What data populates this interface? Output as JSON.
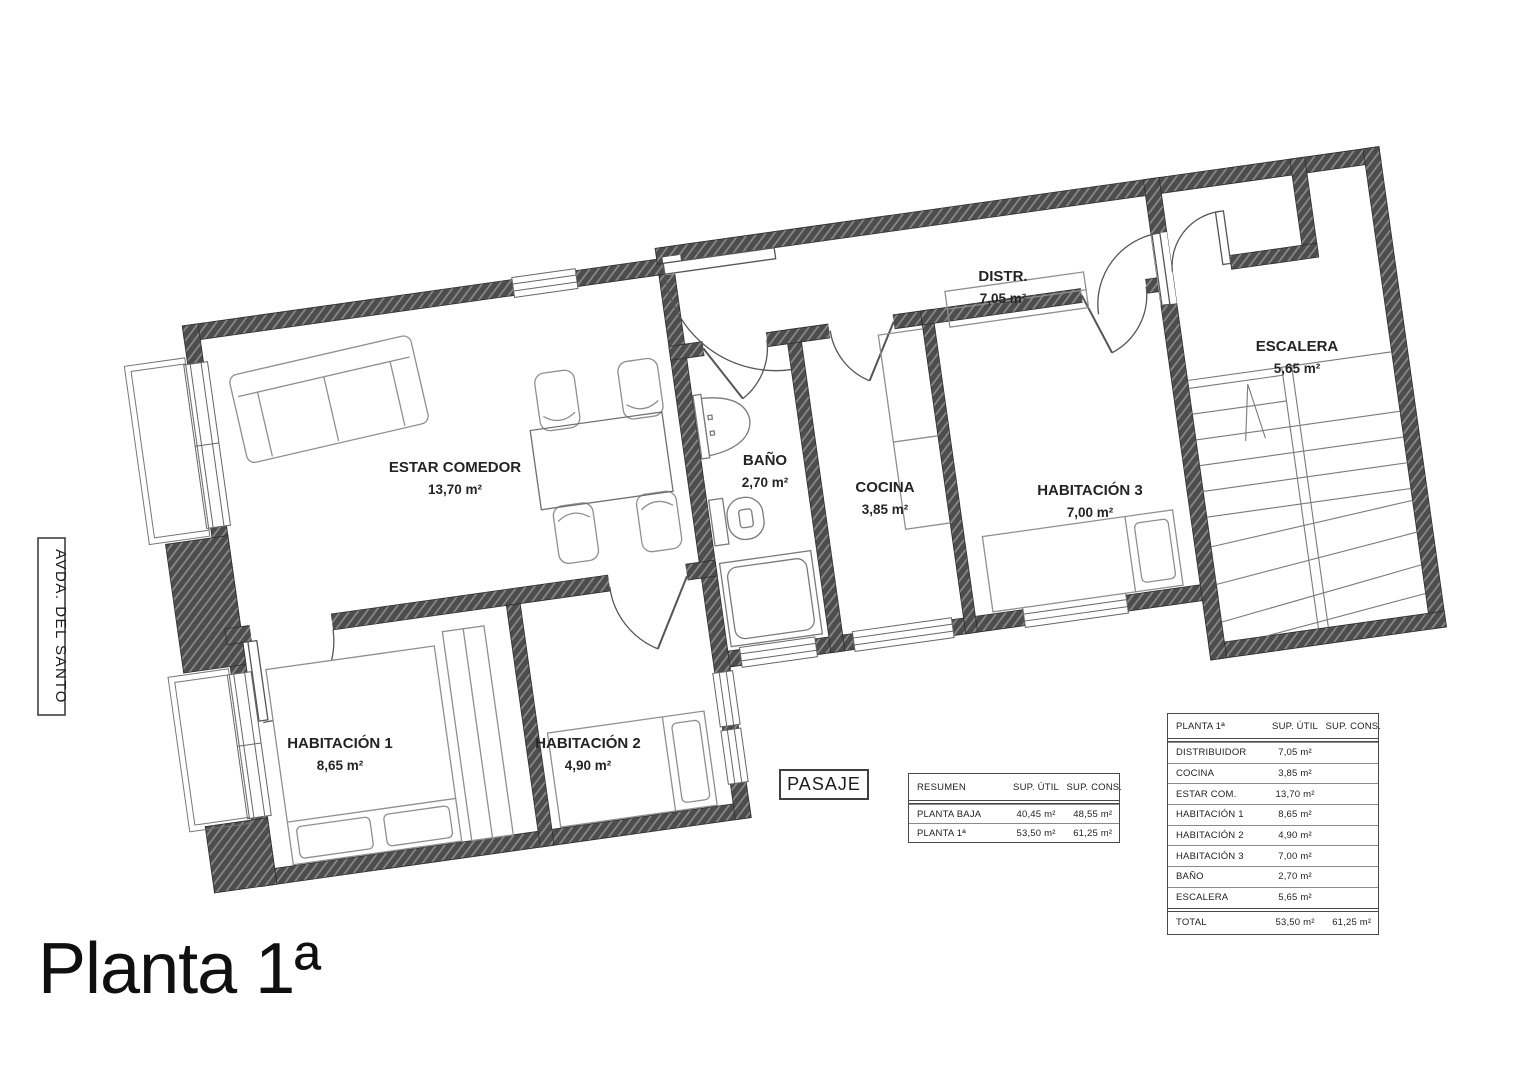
{
  "title": "Planta 1ª",
  "street_label": "AVDA. DEL SANTO",
  "passage_label": "PASAJE",
  "rooms": [
    {
      "name": "ESTAR COMEDOR",
      "area": "13,70 m²"
    },
    {
      "name": "BAÑO",
      "area": "2,70 m²"
    },
    {
      "name": "COCINA",
      "area": "3,85 m²"
    },
    {
      "name": "HABITACIÓN 3",
      "area": "7,00 m²"
    },
    {
      "name": "DISTR.",
      "area": "7,05 m²"
    },
    {
      "name": "ESCALERA",
      "area": "5,65 m²"
    },
    {
      "name": "HABITACIÓN 1",
      "area": "8,65 m²"
    },
    {
      "name": "HABITACIÓN 2",
      "area": "4,90 m²"
    }
  ],
  "summary_table": {
    "headers": [
      "RESUMEN",
      "SUP. ÚTIL",
      "SUP. CONS."
    ],
    "rows": [
      [
        "PLANTA BAJA",
        "40,45 m²",
        "48,55 m²"
      ],
      [
        "PLANTA 1ª",
        "53,50 m²",
        "61,25 m²"
      ]
    ]
  },
  "floor_table": {
    "headers": [
      "PLANTA 1ª",
      "SUP. ÚTIL",
      "SUP. CONS."
    ],
    "rows": [
      [
        "DISTRIBUIDOR",
        "7,05 m²",
        ""
      ],
      [
        "COCINA",
        "3,85 m²",
        ""
      ],
      [
        "ESTAR COM.",
        "13,70 m²",
        ""
      ],
      [
        "HABITACIÓN 1",
        "8,65 m²",
        ""
      ],
      [
        "HABITACIÓN 2",
        "4,90 m²",
        ""
      ],
      [
        "HABITACIÓN 3",
        "7,00 m²",
        ""
      ],
      [
        "BAÑO",
        "2,70 m²",
        ""
      ],
      [
        "ESCALERA",
        "5,65 m²",
        ""
      ]
    ],
    "total_row": [
      "TOTAL",
      "53,50 m²",
      "61,25 m²"
    ]
  },
  "colors": {
    "wall": "#4d4d4d",
    "wall_hatch": "#8a8a8a",
    "door_line": "#555555",
    "furniture_line": "#8f8f8f",
    "text": "#222222"
  }
}
